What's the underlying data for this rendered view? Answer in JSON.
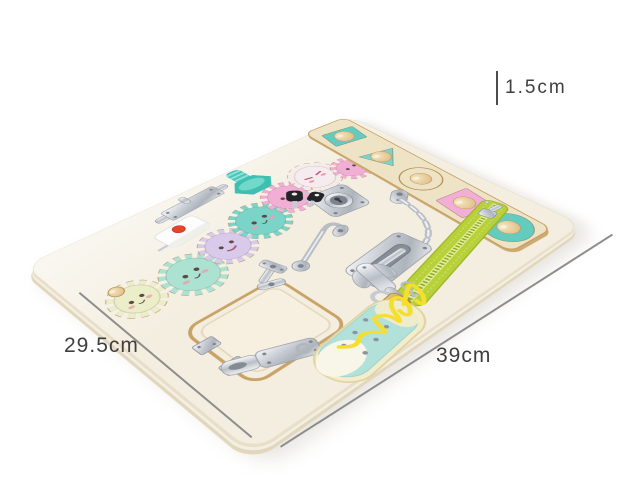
{
  "labels": {
    "thickness": "1.5cm",
    "side": "29.5cm",
    "bottom": "39cm"
  },
  "palette": {
    "label_text": "#3f3f3f",
    "board": "#f4eee0",
    "board_edge": "#e9dfc8",
    "wood_trim": "#c9a266",
    "strip_wood": "#efe3c6",
    "teal": "#63ccbf",
    "teal_light": "#7ad4c8",
    "pink": "#f2aed5",
    "mint": "#abe2d1",
    "lavender": "#d9c9ea",
    "cream_gear": "#ebeec9",
    "blush_white": "#f6ebee",
    "zipper_green": "#b8d138",
    "lace_yellow": "#f6de2c",
    "shoe_blue": "#b2e1da",
    "knob_wood": "#ead2a2",
    "metal_light": "#eef0f3",
    "metal_dark": "#b4bac2",
    "brass": "#c9a24a",
    "key_black": "#212428",
    "screw_teal": "#4cc4b7",
    "bell_button_red": "#e8442a"
  }
}
